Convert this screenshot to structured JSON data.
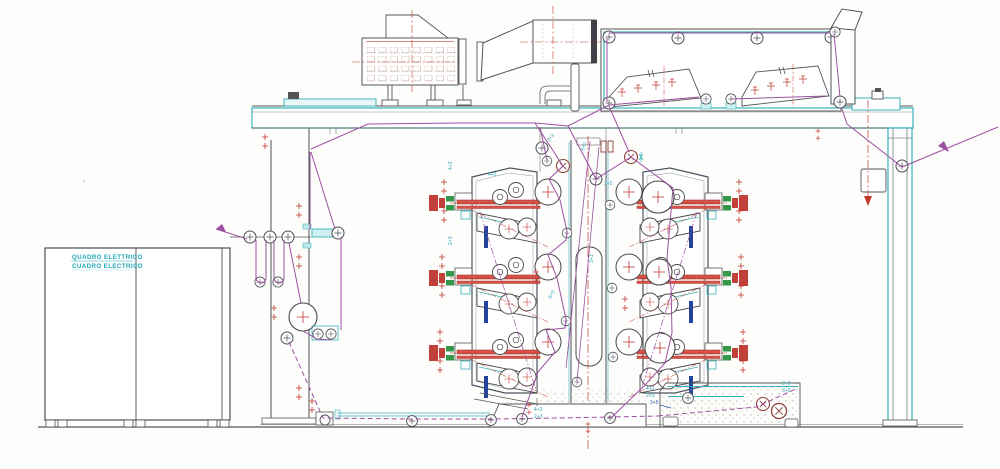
{
  "drawing": {
    "cabinet_label_line1": "QUADRO ELETTRICO",
    "cabinet_label_line2": "CUADRO ELECTRICO"
  },
  "annotations": [
    {
      "text": "4+2"
    },
    {
      "text": "3+5"
    },
    {
      "text": "3+3"
    },
    {
      "text": "6+0"
    },
    {
      "text": "4+2"
    },
    {
      "text": "2+3"
    },
    {
      "text": "4+2"
    },
    {
      "text": "2+3"
    },
    {
      "text": "3+5"
    },
    {
      "text": "8+2"
    },
    {
      "text": "3+2"
    },
    {
      "text": "4+2"
    },
    {
      "text": "2+3"
    },
    {
      "text": "3+1"
    },
    {
      "text": "6+3"
    }
  ],
  "colors": {
    "structure_teal": "#38b2ba",
    "centerline_red": "#c0392f",
    "web_magenta": "#9b50a0",
    "accent_green": "#2f9e4a",
    "pin_blue": "#24439a",
    "line_dark": "#4a4f55",
    "label_cyan": "#1fa9b8"
  }
}
